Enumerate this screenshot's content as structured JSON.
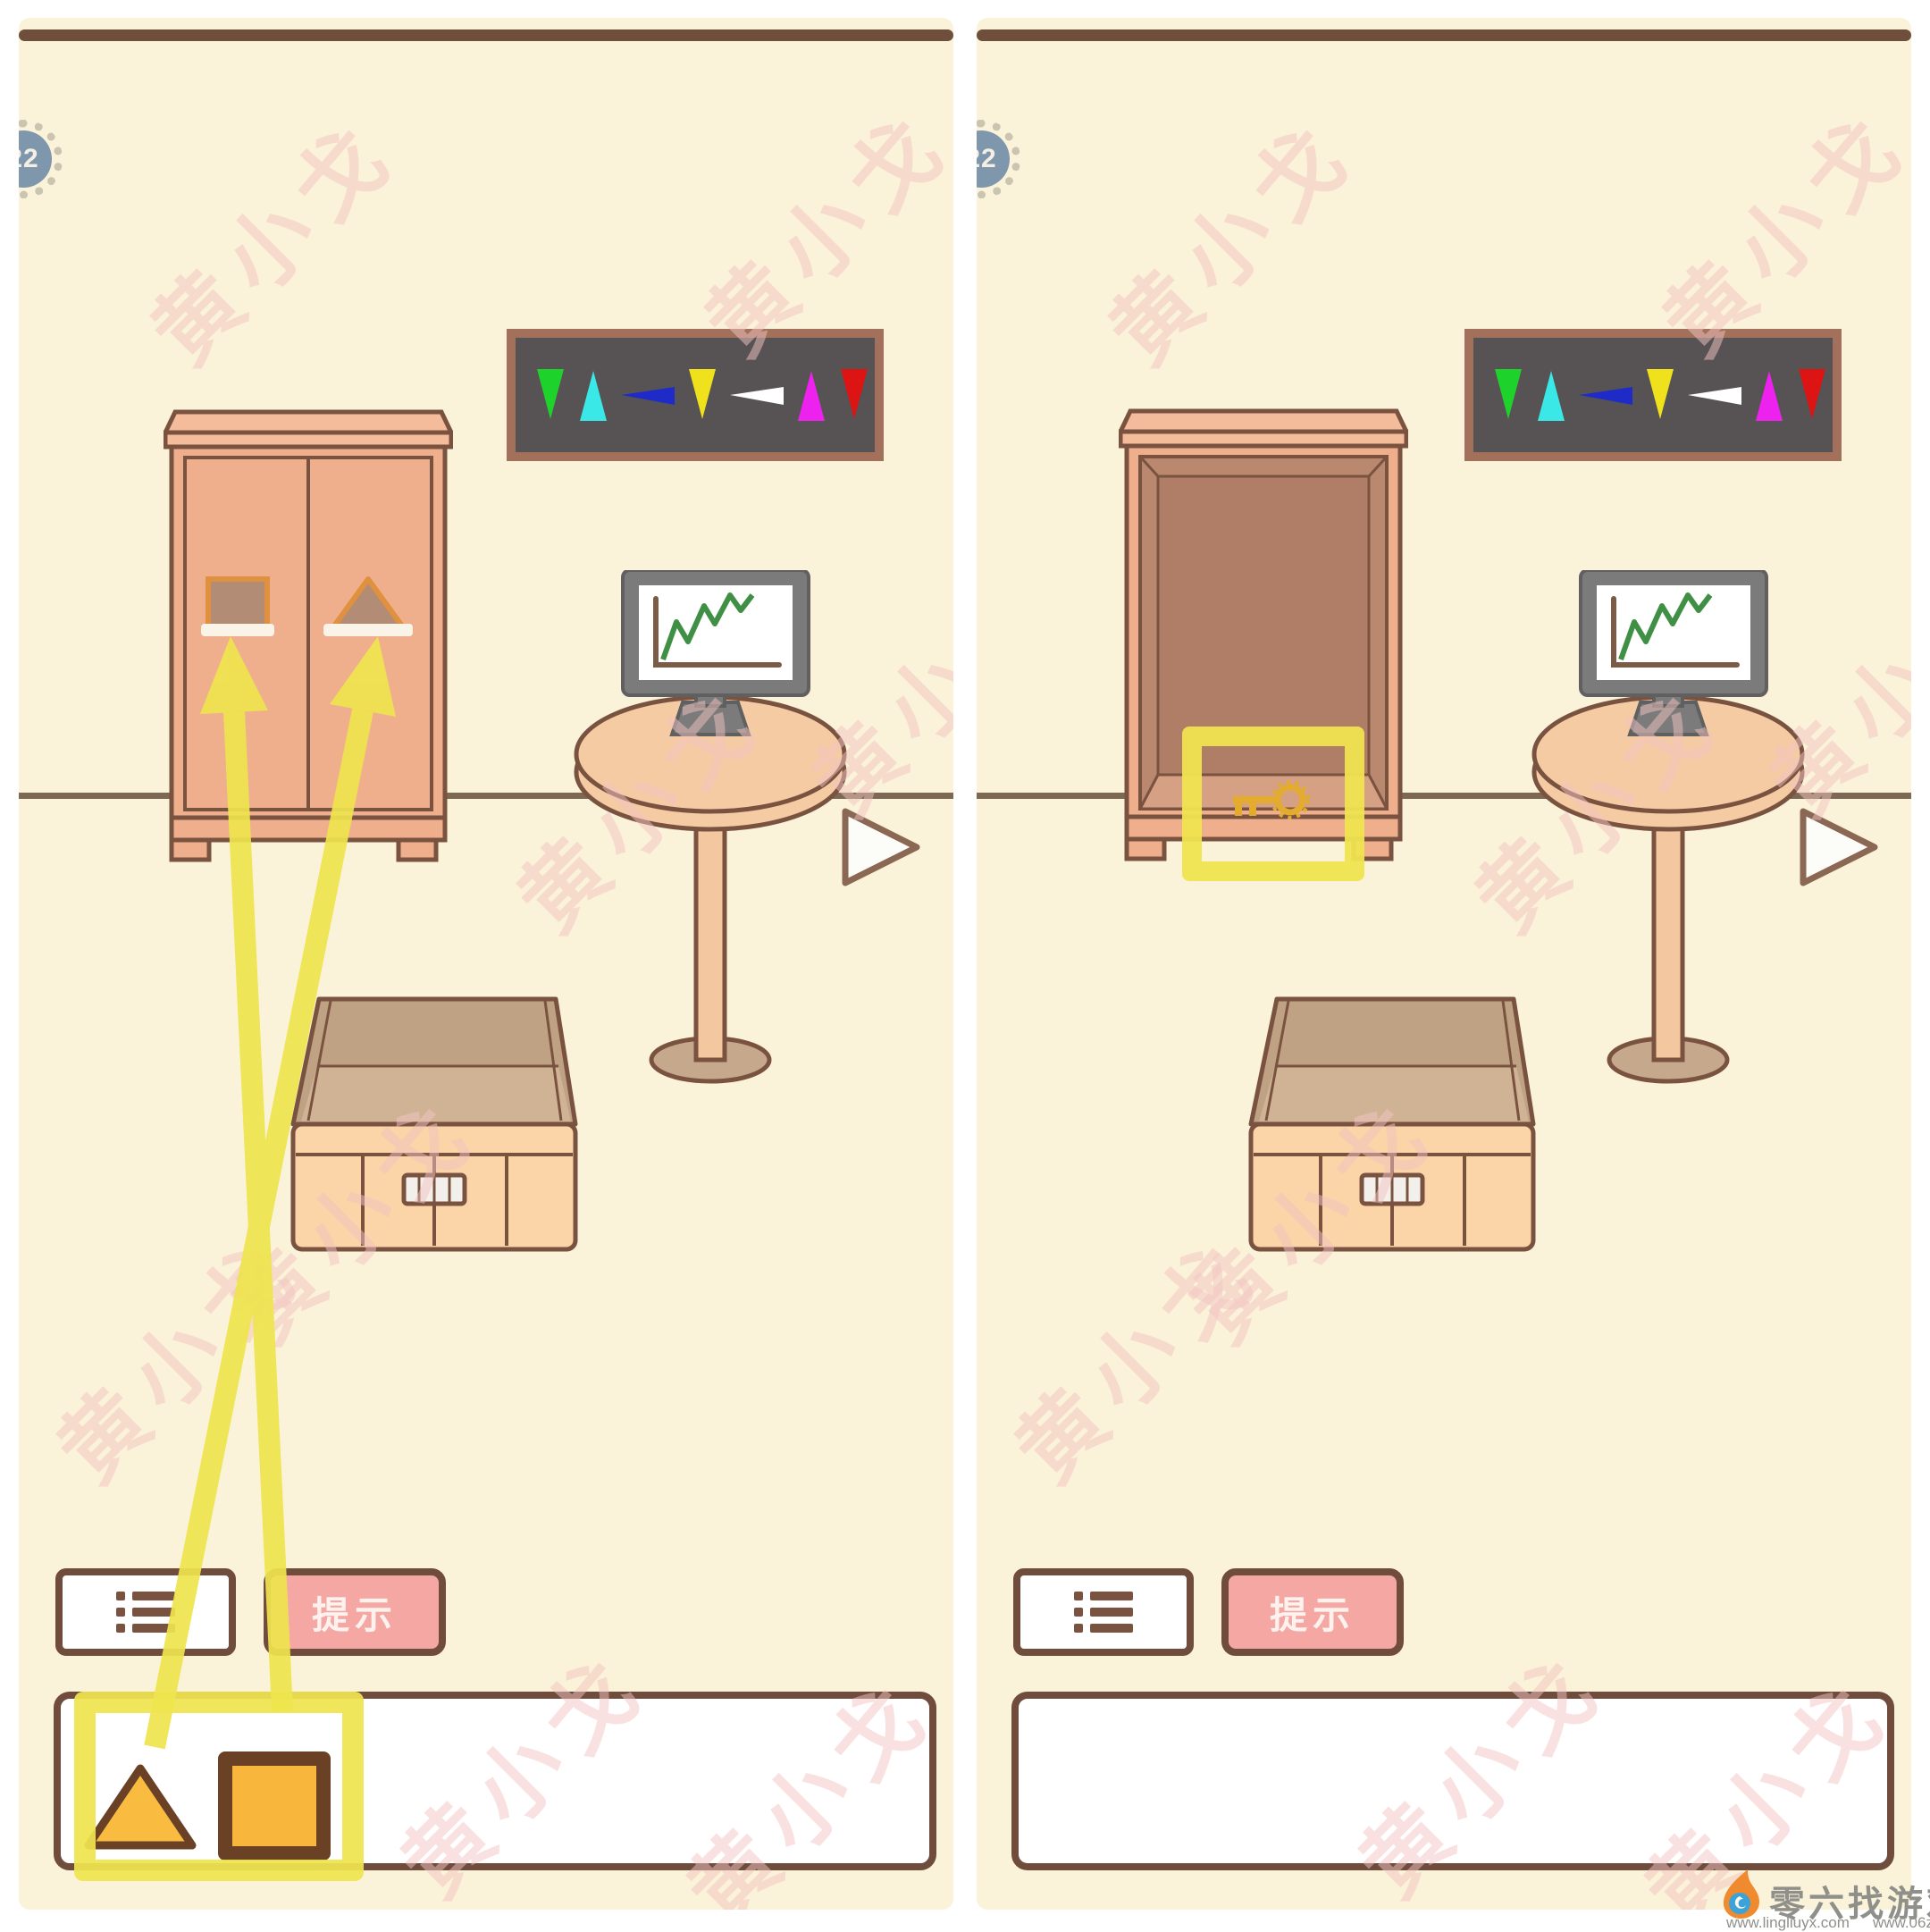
{
  "badge": {
    "level": "22"
  },
  "buttons": {
    "hint": "提示"
  },
  "watermark": {
    "text": "黄小戈"
  },
  "footer": {
    "site_name": "零六找游戏",
    "url_left": "www.lingliuyx.com",
    "url_right": "www.06zyx.com"
  },
  "banner": {
    "background": "#575254",
    "border": "#A3705B",
    "arrows": [
      {
        "color": "#1DD32B",
        "direction": "down"
      },
      {
        "color": "#3BE8E8",
        "direction": "up"
      },
      {
        "color": "#1F2BC9",
        "direction": "left"
      },
      {
        "color": "#EFE11C",
        "direction": "down"
      },
      {
        "color": "#FFFFFF",
        "direction": "left"
      },
      {
        "color": "#EE22EE",
        "direction": "up"
      },
      {
        "color": "#DD1414",
        "direction": "down"
      }
    ]
  },
  "inventory": {
    "left_panel_items": [
      {
        "shape": "triangle",
        "color": "#F9BC41"
      },
      {
        "shape": "square",
        "color": "#F8B63C"
      }
    ],
    "right_panel_items": []
  },
  "wardrobe": {
    "left_panel_state": "closed-with-shape-slots",
    "right_panel_state": "open-with-key",
    "slots": [
      "square",
      "triangle"
    ]
  },
  "tutorial_annotations": {
    "highlight_color": "#EFE44F",
    "arrows": [
      {
        "from": "inventory-triangle-item",
        "to": "wardrobe-triangle-slot"
      },
      {
        "from": "inventory-square-item",
        "to": "wardrobe-square-slot"
      }
    ],
    "highlights": [
      "inventory-items",
      "key-inside-wardrobe"
    ]
  },
  "colors": {
    "panel_background": "#FBF3D9",
    "outline_brown": "#7A5340",
    "wardrobe_fill": "#EFAF8D",
    "wardrobe_crown": "#F4BC9A",
    "slot_fill": "#B28C74",
    "slot_border": "#E0913F",
    "interior_back": "#B07E66",
    "interior_floor": "#D5A083",
    "key_gold": "#E3AC2E",
    "table_fill": "#F5CBA3",
    "monitor_grey": "#7B7B7B",
    "chart_green": "#3F8F44",
    "box_front": "#FBD4A7",
    "hint_pink": "#F4A7A3",
    "item_amber": "#F9BC41",
    "badge_blue": "#7E97AC"
  }
}
